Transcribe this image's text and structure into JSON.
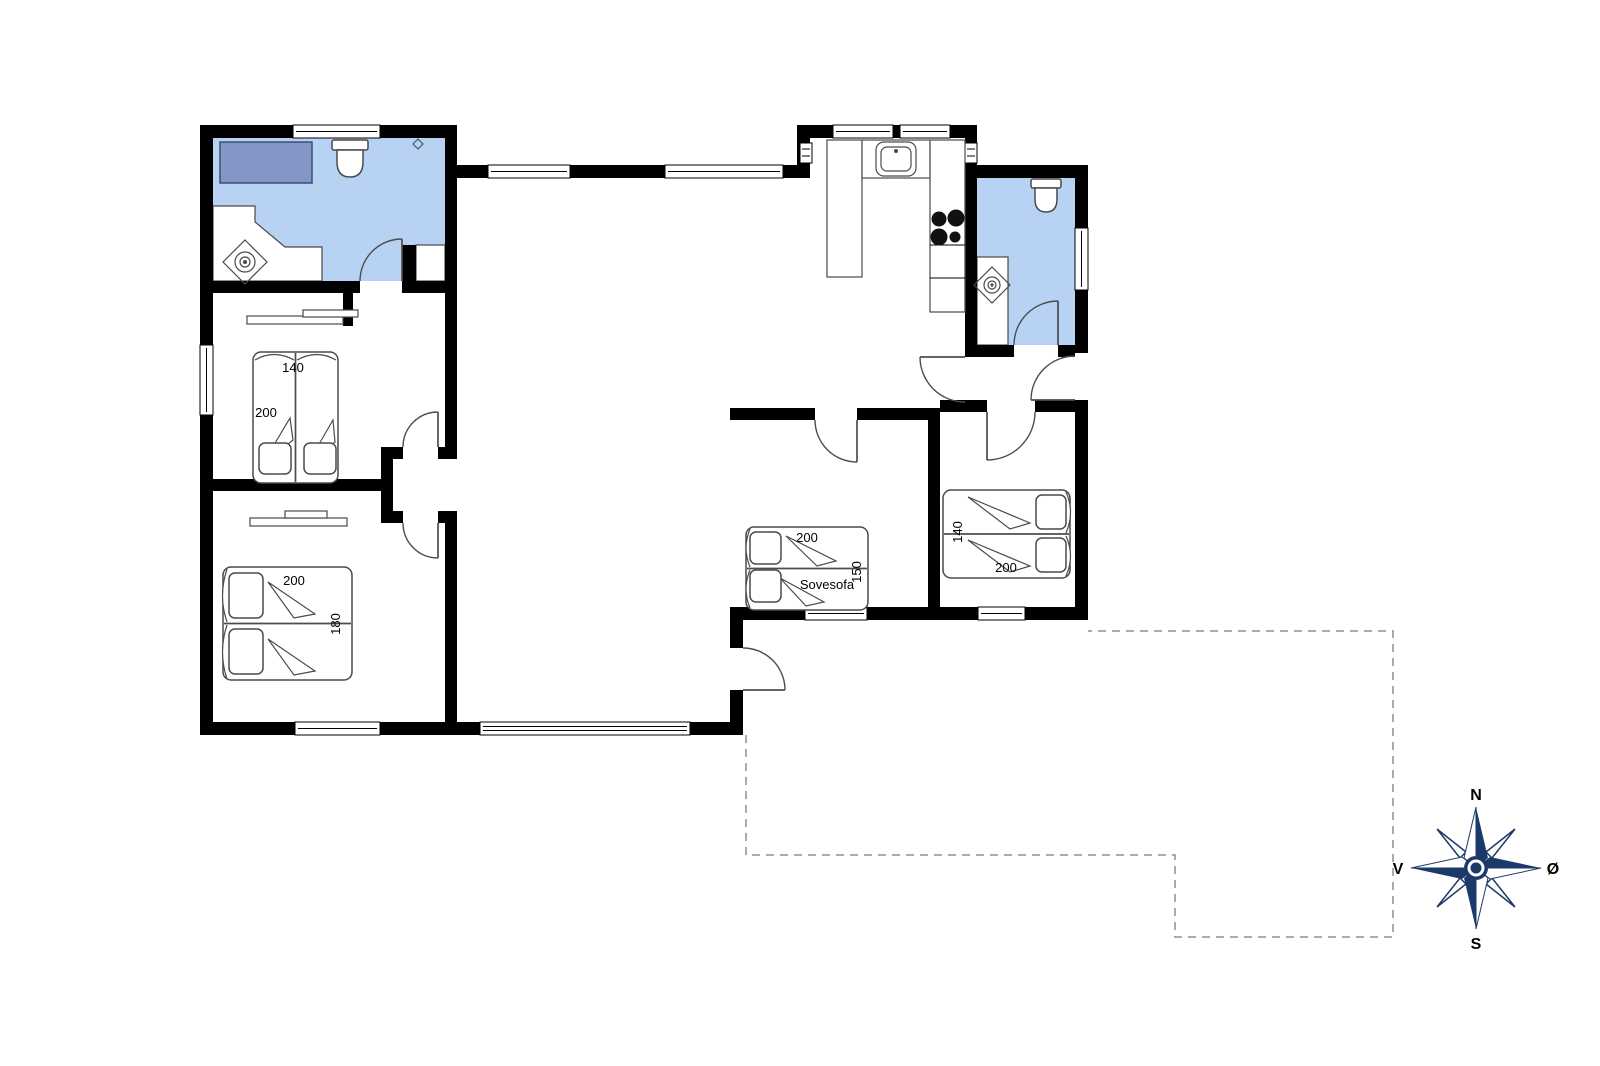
{
  "floorplan": {
    "colors": {
      "wall": "#000000",
      "bathroom_floor": "#b7d2f2",
      "shower": "#8496c6",
      "compass_navy": "#1c3a69",
      "terrace_dash": "#8f8f8f"
    },
    "beds": {
      "bedroom1": {
        "width": "140",
        "length": "200"
      },
      "bedroom2": {
        "length": "200",
        "width": "180"
      },
      "sofa_bed": {
        "length": "200",
        "width": "150",
        "name": "Sovesofa"
      },
      "bedroom3": {
        "width": "140",
        "length": "200"
      }
    },
    "compass": {
      "north": "N",
      "south": "S",
      "west": "V",
      "east": "Ø"
    }
  }
}
